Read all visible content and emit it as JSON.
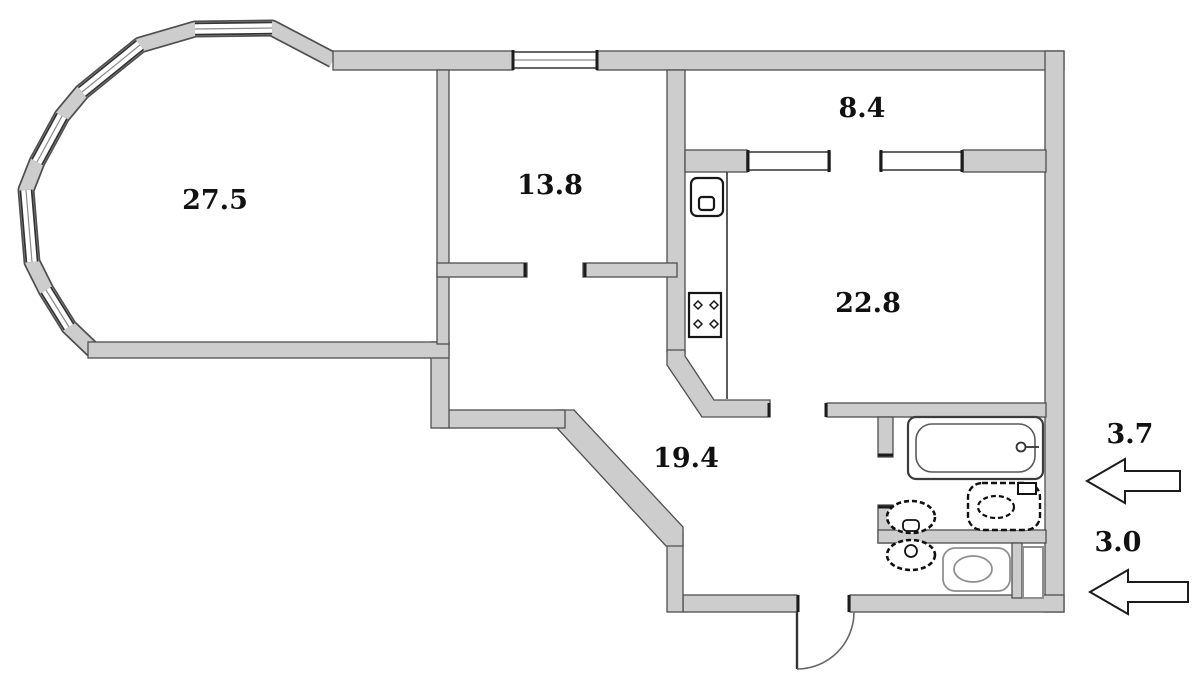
{
  "document": {
    "type": "apartment-floor-plan"
  },
  "colors": {
    "background": "#ffffff",
    "wall_fill": "#cdcdcd",
    "wall_edge": "#4f4f4f",
    "fixture_dark": "#161616",
    "fixture_light": "#8f8f8f",
    "label": "#111111"
  },
  "rooms": [
    {
      "name": "living-room",
      "area_label": "27.5"
    },
    {
      "name": "bedroom",
      "area_label": "13.8"
    },
    {
      "name": "entrance-hall",
      "area_label": "8.4"
    },
    {
      "name": "kitchen-living",
      "area_label": "22.8"
    },
    {
      "name": "corridor",
      "area_label": "19.4"
    },
    {
      "name": "balcony-upper",
      "area_label": "3.7"
    },
    {
      "name": "balcony-lower",
      "area_label": "3.0"
    }
  ],
  "fixtures": {
    "kitchen_sink": "kitchen-sink-icon",
    "stove": "stove-icon",
    "bathtub": "bathtub-icon",
    "bath_washbasin": "washbasin-icon",
    "bath_toilet": "toilet-icon",
    "wc_washbasin": "washbasin-icon",
    "wc_toilet": "toilet-icon",
    "duct": "duct-shaft-box",
    "entrance_door": "door-swing-arc",
    "bay_windows": "bay-window-band",
    "sliding_partition": "sliding-door-panels"
  }
}
